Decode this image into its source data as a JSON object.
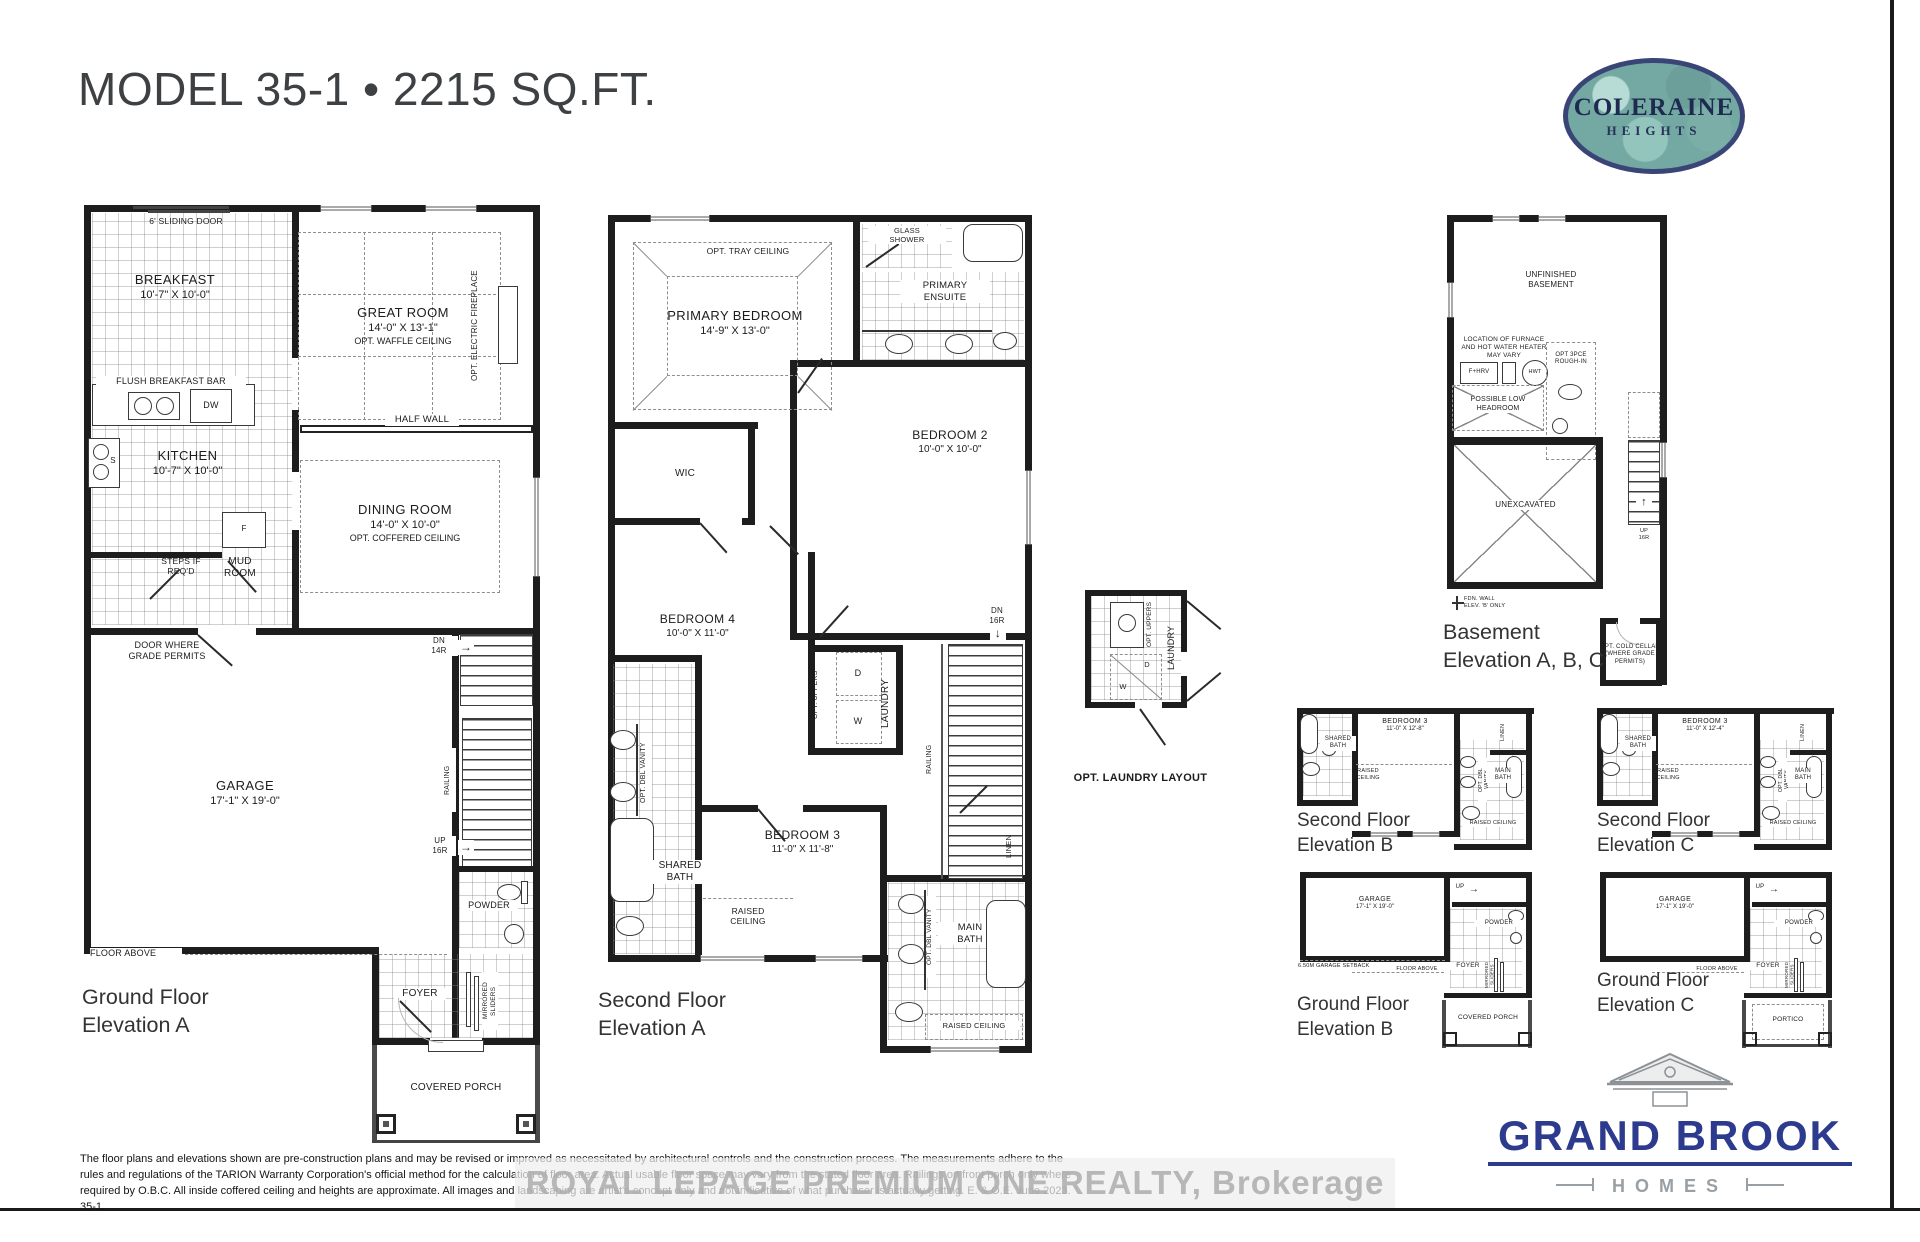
{
  "page": {
    "title": "MODEL 35-1 • 2215 SQ.FT.",
    "watermark": "ROYAL LEPAGE PREMIUM ONE REALTY, Brokerage",
    "disclaimer": "The floor plans and elevations shown are pre-construction plans and may be revised or improved as necessitated by architectural controls and the construction process. The measurements adhere to the rules and regulations of the TARION Warranty Corporation's official method for the calculation of floor area. Actual usable floor space may vary from the stated floor area. Railings on front porch only where required by O.B.C. All inside coffered ceiling and heights are approximate. All images and landscaping are artist's concept only and not indicative of what purchaser is actually getting. E. & O.E. June 2023. 35-1.",
    "arrow_right": "→",
    "arrow_down": "↓",
    "arrow_up": "↑"
  },
  "logos": {
    "community_name": "COLERAINE",
    "community_sub": "HEIGHTS",
    "builder_name": "GRAND BROOK",
    "builder_sub": "HOMES"
  },
  "ground_a": {
    "caption": "Ground Floor\nElevation A",
    "sliding_door": "6' SLIDING DOOR",
    "breakfast_name": "BREAKFAST",
    "breakfast_dims": "10'-7\" X 10'-0\"",
    "great_name": "GREAT ROOM",
    "great_dims": "14'-0\" X 13'-1\"",
    "great_note": "OPT. WAFFLE CEILING",
    "fireplace": "OPT. ELECTRIC FIREPLACE",
    "flush_bar": "FLUSH BREAKFAST BAR",
    "dw": "DW",
    "s": "S",
    "f": "F",
    "half_wall": "HALF WALL",
    "kitchen_name": "KITCHEN",
    "kitchen_dims": "10'-7\" X 10'-0\"",
    "dining_name": "DINING ROOM",
    "dining_dims": "14'-0\" X 10'-0\"",
    "dining_note": "OPT. COFFERED CEILING",
    "steps": "STEPS IF\nREQ'D",
    "mud": "MUD\nROOM",
    "door_grade": "DOOR WHERE\nGRADE PERMITS",
    "dn": "DN\n14R",
    "garage_name": "GARAGE",
    "garage_dims": "17'-1\" X 19'-0\"",
    "railing": "RAILING",
    "up": "UP\n16R",
    "floor_above": "FLOOR ABOVE",
    "powder": "POWDER",
    "foyer": "FOYER",
    "mirrored": "MIRRORED\nSLIDERS",
    "porch": "COVERED PORCH"
  },
  "second_a": {
    "caption": "Second Floor\nElevation A",
    "tray": "OPT. TRAY CEILING",
    "primary_name": "PRIMARY BEDROOM",
    "primary_dims": "14'-9\" X 13'-0\"",
    "glass_shower": "GLASS\nSHOWER",
    "ensuite": "PRIMARY\nENSUITE",
    "bed2_name": "BEDROOM 2",
    "bed2_dims": "10'-0\" X 10'-0\"",
    "wic": "WIC",
    "bed4_name": "BEDROOM 4",
    "bed4_dims": "10'-0\" X 11'-0\"",
    "opt_uppers": "OPT. UPPERS",
    "d": "D",
    "w": "W",
    "laundry": "LAUNDRY",
    "dn": "DN\n16R",
    "railing": "RAILING",
    "vanity1": "OPT. DBL VANITY",
    "shared": "SHARED\nBATH",
    "bed3_name": "BEDROOM 3",
    "bed3_dims": "11'-0\" X 11'-8\"",
    "raised1": "RAISED\nCEILING",
    "main_bath": "MAIN\nBATH",
    "vanity2": "OPT. DBL VANITY",
    "linen": "LINEN",
    "raised2": "RAISED CEILING"
  },
  "opt_laundry": {
    "caption": "OPT. LAUNDRY LAYOUT",
    "opt_uppers": "OPT. UPPERS",
    "laundry": "LAUNDRY",
    "d": "D",
    "w": "W"
  },
  "basement": {
    "caption": "Basement\nElevation A, B, C",
    "unfinished": "UNFINISHED\nBASEMENT",
    "furnace_note": "LOCATION OF FURNACE\nAND HOT WATER HEATER\nMAY VARY",
    "fhrv": "F+HRV",
    "hwt": "HWT",
    "rough_in": "OPT 3PCE\nROUGH-IN",
    "low_headroom": "POSSIBLE LOW\nHEADROOM",
    "unexcavated": "UNEXCAVATED",
    "fdn_note": "FDN. WALL\nELEV. 'B' ONLY",
    "up": "UP\n16R",
    "cold_cellar": "OPT. COLD CELLAR\n(WHERE GRADE PERMITS)"
  },
  "second_b": {
    "caption": "Second Floor\nElevation B",
    "bed3_name": "BEDROOM 3",
    "bed3_dims": "11'-0\" X 12'-8\"",
    "shared": "SHARED\nBATH",
    "raised1": "RAISED\nCEILING",
    "linen": "LINEN",
    "main_bath": "MAIN\nBATH",
    "vanity": "OPT. DBL VANITY",
    "raised2": "RAISED CEILING"
  },
  "second_c": {
    "caption": "Second Floor\nElevation C",
    "bed3_name": "BEDROOM 3",
    "bed3_dims": "11'-0\" X 12'-4\"",
    "shared": "SHARED\nBATH",
    "raised1": "RAISED\nCEILING",
    "linen": "LINEN",
    "main_bath": "MAIN\nBATH",
    "vanity": "OPT. DBL VANITY",
    "raised2": "RAISED CEILING"
  },
  "ground_b": {
    "caption": "Ground Floor\nElevation B",
    "garage_name": "GARAGE",
    "garage_dims": "17'-1\" X 19'-0\"",
    "setback": "6.50M GARAGE SETBACK",
    "floor_above": "FLOOR ABOVE",
    "powder": "POWDER",
    "foyer": "FOYER",
    "mirrored": "MIRRORED\nSLIDERS",
    "up": "UP",
    "porch": "COVERED PORCH"
  },
  "ground_c": {
    "caption": "Ground Floor\nElevation C",
    "garage_name": "GARAGE",
    "garage_dims": "17'-1\" X 19'-0\"",
    "floor_above": "FLOOR ABOVE",
    "powder": "POWDER",
    "foyer": "FOYER",
    "mirrored": "MIRRORED\nSLIDERS",
    "up": "UP",
    "portico": "PORTICO"
  }
}
